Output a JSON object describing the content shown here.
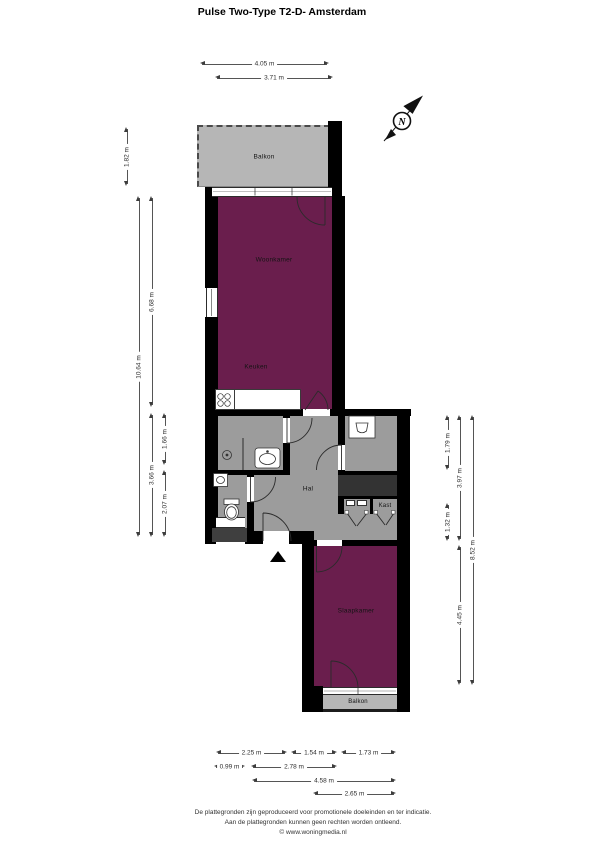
{
  "title": "Pulse Two-Type T2-D- Amsterdam",
  "compass": {
    "north_label": "N"
  },
  "rooms": {
    "balkon_top": "Balkon",
    "woonkamer": "Woonkamer",
    "keuken": "Keuken",
    "hal": "Hal",
    "kast": "Kast",
    "slaapkamer": "Slaapkamer",
    "balkon_bottom": "Balkon"
  },
  "dimensions": {
    "top": [
      "4.05 m",
      "3.71 m"
    ],
    "left": [
      "1.82 m",
      "10.64 m",
      "6.68 m",
      "3.66 m",
      "1.66 m",
      "2.07 m"
    ],
    "right": [
      "1.79 m",
      "3.97 m",
      "1.32 m",
      "8.52 m",
      "4.45 m"
    ],
    "bottom": [
      "2.25 m",
      "1.54 m",
      "1.73 m",
      "0.99 m",
      "2.78 m",
      "4.58 m",
      "2.65 m"
    ]
  },
  "footer": {
    "line1": "De plattegronden zijn geproduceerd voor promotionele doeleinden en ter indicatie.",
    "line2": "Aan de plattegronden kunnen geen rechten worden ontleend.",
    "line3": "© www.woningmedia.nl"
  },
  "colors": {
    "room_accent": "#6a1e4d",
    "floor_gray": "#9c9c9c",
    "balcony_gray": "#b6b6b6",
    "wall": "#000000",
    "shaft": "#333333"
  }
}
